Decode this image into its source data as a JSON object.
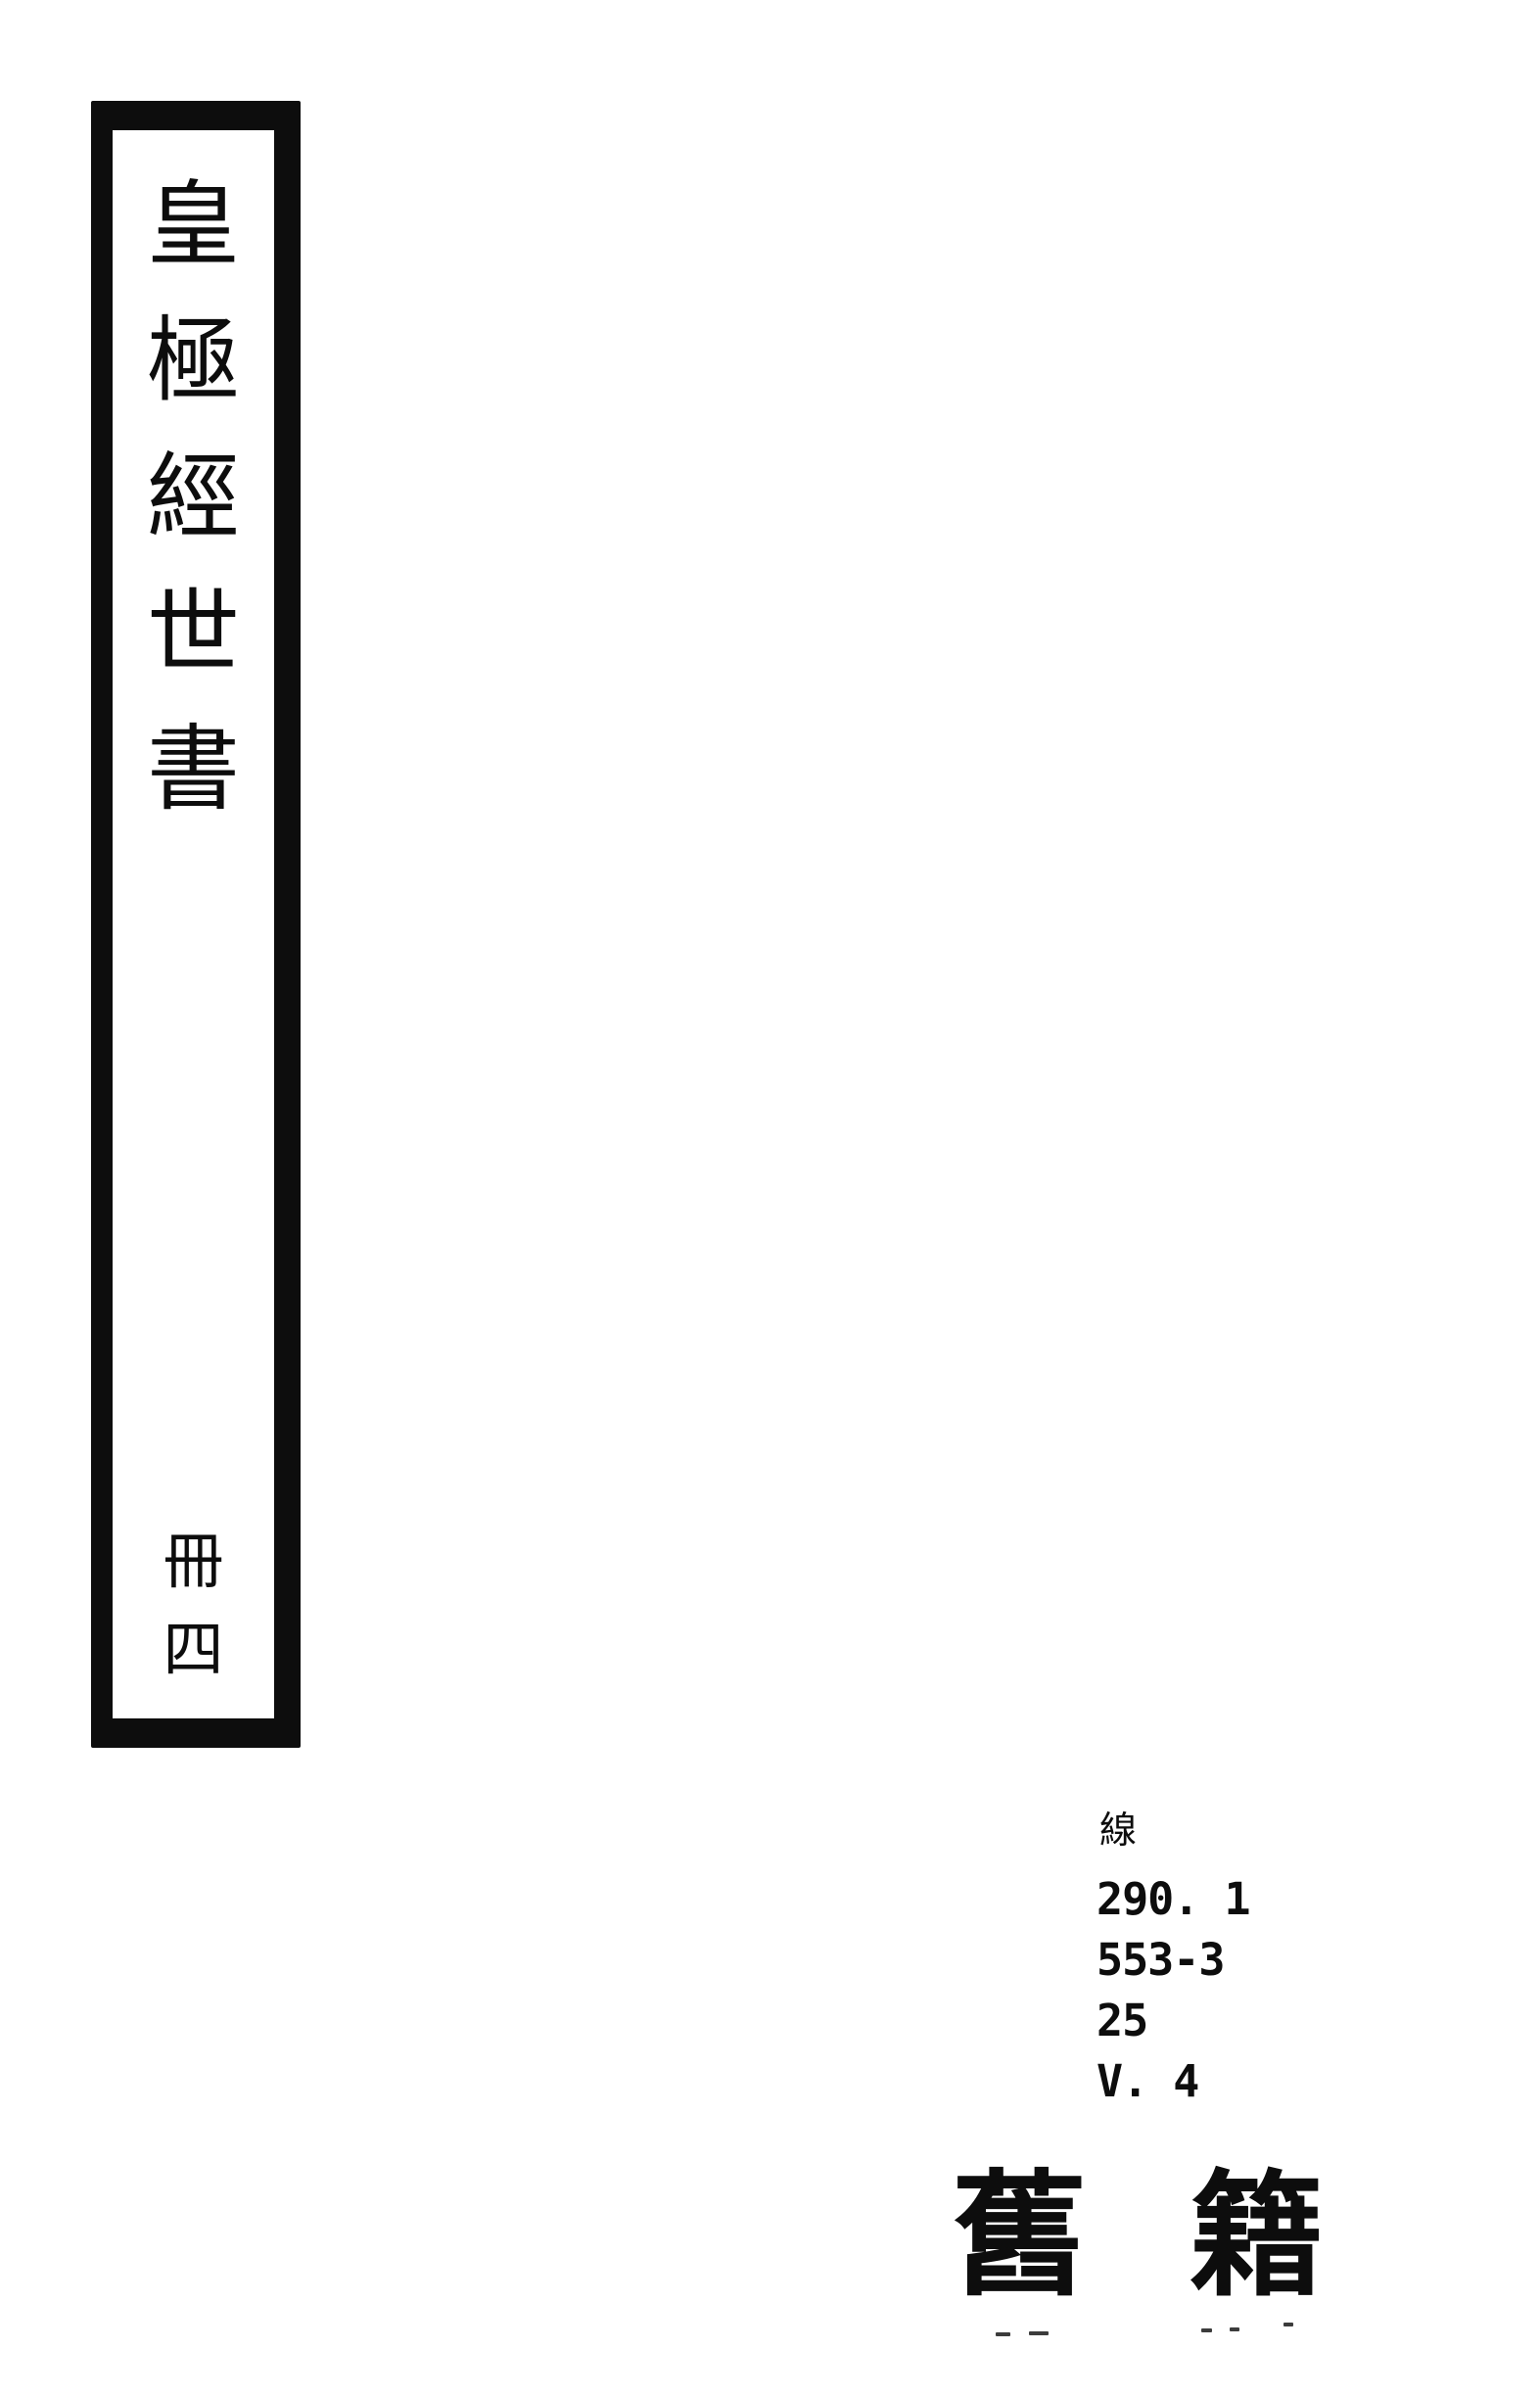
{
  "colors": {
    "ink": "#0d0d0d",
    "paper": "#ffffff"
  },
  "spine": {
    "title": "皇極經世書",
    "title_chars": [
      "皇",
      "極",
      "經",
      "世",
      "書"
    ],
    "volume": "冊四",
    "volume_chars": [
      "冊",
      "四"
    ]
  },
  "call_number": {
    "binding_label": "線",
    "lines": [
      "290. 1",
      "553-3",
      "25",
      "V. 4"
    ]
  },
  "category": {
    "text": "舊籍",
    "chars": [
      "舊",
      "籍"
    ]
  }
}
